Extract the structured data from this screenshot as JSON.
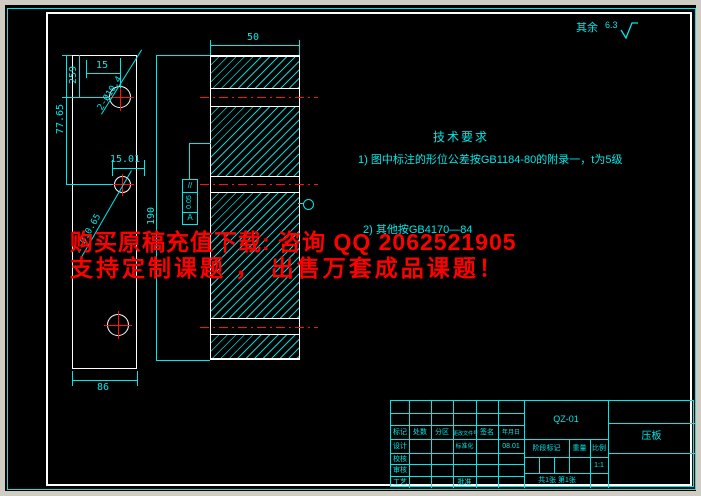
{
  "roughness": {
    "prefix": "其余",
    "value": "6.3"
  },
  "tech": {
    "title": "技术要求",
    "item1": "1) 图中标注的形位公差按GB1184-80的附录一，t为5级",
    "item2": "2) 其他按GB4170—84"
  },
  "watermark": {
    "line1": "购买原稿充值下载: 咨询 QQ 2062521905",
    "line2": "支持定制课题 ， 出售万套成品课题！",
    "color": "#ff0000"
  },
  "front_view": {
    "dim_top": "15",
    "dim_top_left": "259",
    "dim_left": "77.65",
    "dim_mid": "15.01",
    "dim_bottom": "86",
    "holes_label_top": "2-Ø10.4",
    "holes_label_bottom": "2-Ø10.65"
  },
  "section_view": {
    "dim_width": "50",
    "dim_height": "190",
    "fcf": {
      "symbol": "//",
      "tolerance": "0.05",
      "datum": "A"
    }
  },
  "title_block": {
    "code": "QZ-01",
    "part_name": "压板",
    "cols": [
      "标记",
      "处数",
      "分区",
      "更改文件号",
      "签名",
      "年月日"
    ],
    "row_design": "设计",
    "row_check": "校核",
    "row_review": "审核",
    "row_process": "工艺",
    "standardization": "标准化",
    "approval": "批准",
    "design_date": "08.01",
    "stage_mark": "阶段标记",
    "weight": "重量",
    "scale_label": "比例",
    "scale_value": "1:1",
    "sheet_info": "共1张 第1张"
  },
  "colors": {
    "line_cyan": "#00e8e8",
    "geometry_white": "#ffffff",
    "centerline_red": "#ff1010"
  }
}
